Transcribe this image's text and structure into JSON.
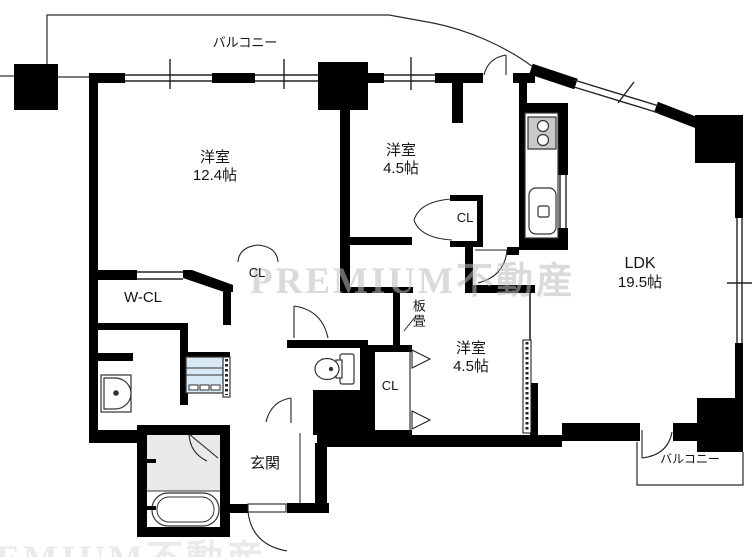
{
  "document_type": "apartment-floor-plan",
  "rooms": {
    "bedroom_main": {
      "name": "洋室",
      "size": "12.4帖"
    },
    "bedroom_north": {
      "name": "洋室",
      "size": "4.5帖"
    },
    "bedroom_south": {
      "name": "洋室",
      "size": "4.5帖"
    },
    "ldk": {
      "name": "LDK",
      "size": "19.5帖"
    },
    "entrance": {
      "name": "玄関"
    },
    "walk_in_closet": {
      "name": "W-CL"
    },
    "itajo": {
      "name": "板畳"
    }
  },
  "closets": {
    "north": "CL",
    "main": "CL",
    "south": "CL"
  },
  "balconies": {
    "top": "バルコニー",
    "bottom_right": "バルコニー"
  },
  "watermark": "PREMIUM不動産",
  "fixtures": [
    "kitchen-stove",
    "kitchen-sink",
    "toilet",
    "bathtub",
    "shower-room",
    "vanity-sink",
    "washing-machine"
  ],
  "colors": {
    "wall": "#000000",
    "floor": "#ffffff",
    "shower_floor": "#e9e9e9",
    "washer_fill": "#d8eaf5",
    "stove_fill": "#c9c9c9",
    "watermark": "#bdbdbd"
  }
}
